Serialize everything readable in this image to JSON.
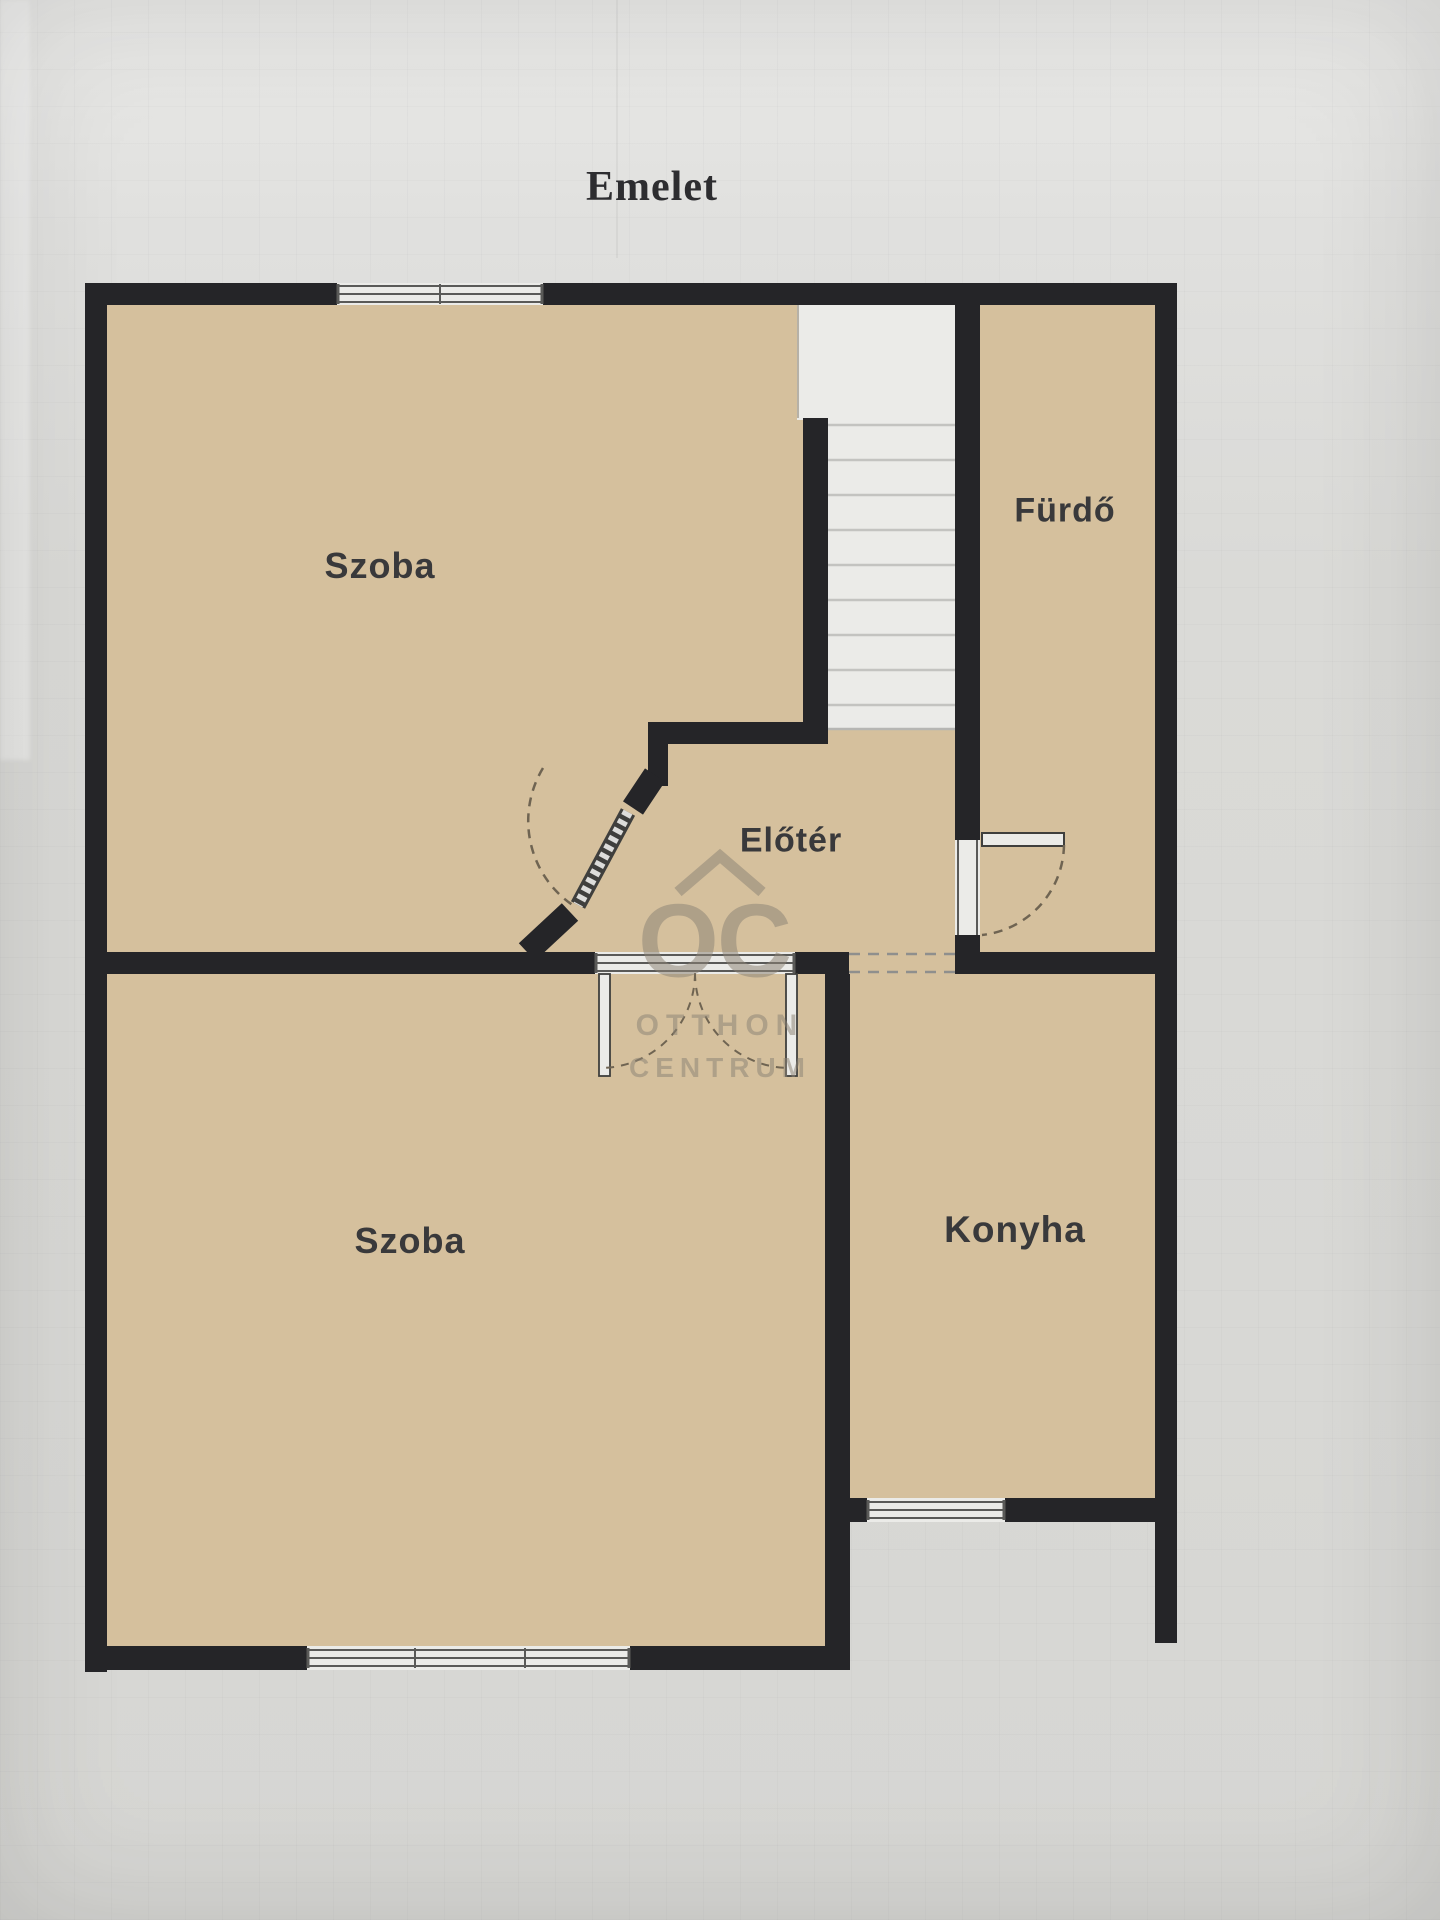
{
  "title": "Emelet",
  "rooms": [
    {
      "id": "szoba-top",
      "label": "Szoba"
    },
    {
      "id": "furdo",
      "label": "Fürdő"
    },
    {
      "id": "eloter",
      "label": "Előtér"
    },
    {
      "id": "szoba-bottom",
      "label": "Szoba"
    },
    {
      "id": "konyha",
      "label": "Konyha"
    }
  ],
  "watermark": {
    "monogram": "OC",
    "name_line1": "OTTHON",
    "name_line2": "CENTRUM"
  },
  "colors": {
    "wall": "#252528",
    "room": "#d5c09d",
    "stairs": "#ebebe8",
    "frame": "#5a5a58",
    "arc": "#6f6452",
    "label": "#39393b",
    "watermark": "#8c8375"
  }
}
